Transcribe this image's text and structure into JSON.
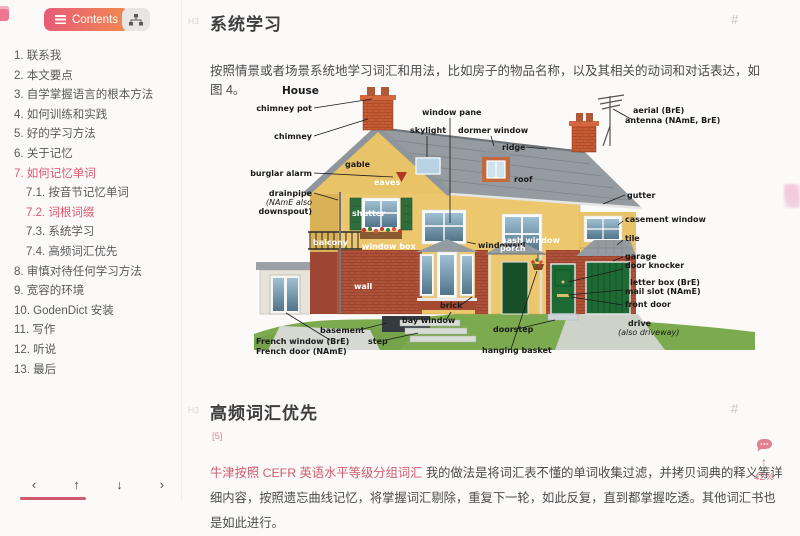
{
  "sidebar": {
    "contents_button": "Contents",
    "toc": [
      {
        "label": "1. 联系我"
      },
      {
        "label": "2. 本文要点"
      },
      {
        "label": "3. 自学掌握语言的根本方法"
      },
      {
        "label": "4. 如何训练和实践"
      },
      {
        "label": "5. 好的学习方法"
      },
      {
        "label": "6. 关于记忆"
      },
      {
        "label": "7. 如何记忆单词",
        "active": true
      },
      {
        "label": "7.1. 按音节记忆单词",
        "indent": 1
      },
      {
        "label": "7.2. 词根词缀",
        "indent": 1,
        "active": true
      },
      {
        "label": "7.3. 系统学习",
        "indent": 1
      },
      {
        "label": "7.4. 高频词汇优先",
        "indent": 1
      },
      {
        "label": "8. 审慎对待任何学习方法"
      },
      {
        "label": "9. 宽容的环境"
      },
      {
        "label": "10. GodenDict 安装"
      },
      {
        "label": "11. 写作"
      },
      {
        "label": "12. 听说"
      },
      {
        "label": "13. 最后"
      }
    ],
    "footer_arrows": [
      "‹",
      "↑",
      "↓",
      "›"
    ]
  },
  "content": {
    "section1": {
      "level_marker": "H3",
      "title": "系统学习",
      "anchor": "#",
      "paragraph": "按照情景或者场景系统地学习词汇和用法，比如房子的物品名称，以及其相关的动词和对话表达，如图 4。"
    },
    "section2": {
      "level_marker": "H3",
      "title": "高频词汇优先",
      "anchor": "#",
      "footnote": "[5]",
      "link_text": "牛津按照 CEFR 英语水平等级分组词汇",
      "paragraph_rest": " 我的做法是将词汇表不懂的单词收集过滤，并拷贝词典的释义等详细内容，按照遗忘曲线记忆，将掌握词汇剔除，重复下一轮，如此反复，直到都掌握吃透。其他词汇书也是如此进行。"
    }
  },
  "figure_labels": [
    {
      "t": "House",
      "x": 32,
      "y": 12,
      "a": "s",
      "c": "d",
      "sz": 10.5
    },
    {
      "t": "chimney pot",
      "x": 62,
      "y": 29,
      "a": "e",
      "c": "d",
      "ln": [
        64,
        26,
        122,
        17
      ]
    },
    {
      "t": "chimney",
      "x": 62,
      "y": 57,
      "a": "e",
      "c": "d",
      "ln": [
        64,
        54,
        118,
        37
      ]
    },
    {
      "t": "burglar alarm",
      "x": 62,
      "y": 94,
      "a": "e",
      "c": "d",
      "ln": [
        64,
        91,
        143,
        95
      ]
    },
    {
      "t": "drainpipe",
      "x": 62,
      "y": 114,
      "a": "e",
      "c": "d",
      "ln": [
        64,
        111,
        88,
        118
      ]
    },
    {
      "t": "(NAmE also",
      "x": 62,
      "y": 123,
      "a": "e",
      "c": "d",
      "it": 1
    },
    {
      "t": "downspout)",
      "x": 62,
      "y": 132,
      "a": "e",
      "c": "d"
    },
    {
      "t": "French window (BrE)",
      "x": 6,
      "y": 262,
      "a": "s",
      "c": "d",
      "ln": [
        80,
        258,
        36,
        231
      ]
    },
    {
      "t": "French door (NAmE)",
      "x": 6,
      "y": 272,
      "a": "s",
      "c": "d"
    },
    {
      "t": "basement",
      "x": 70,
      "y": 251,
      "a": "s",
      "c": "d",
      "ln": [
        109,
        248,
        137,
        241
      ]
    },
    {
      "t": "step",
      "x": 118,
      "y": 262,
      "a": "s",
      "c": "d",
      "ln": [
        136,
        258,
        168,
        251
      ]
    },
    {
      "t": "bay window",
      "x": 152,
      "y": 241,
      "a": "s",
      "c": "d",
      "ln": [
        196,
        238,
        201,
        230
      ]
    },
    {
      "t": "doorstep",
      "x": 243,
      "y": 250,
      "a": "s",
      "c": "d",
      "ln": [
        267,
        247,
        305,
        238
      ]
    },
    {
      "t": "hanging basket",
      "x": 232,
      "y": 271,
      "a": "s",
      "c": "d",
      "ln": [
        261,
        267,
        287,
        189
      ]
    },
    {
      "t": "brick",
      "x": 190,
      "y": 226,
      "a": "s",
      "c": "d",
      "ln": [
        211,
        223,
        222,
        215
      ]
    },
    {
      "t": "window pane",
      "x": 172,
      "y": 33,
      "a": "s",
      "c": "d",
      "ln": [
        200,
        36,
        200,
        141
      ]
    },
    {
      "t": "skylight",
      "x": 160,
      "y": 51,
      "a": "s",
      "c": "d",
      "ln": [
        177,
        54,
        177,
        75
      ]
    },
    {
      "t": "dormer window",
      "x": 208,
      "y": 51,
      "a": "s",
      "c": "d",
      "ln": [
        241,
        54,
        244,
        64
      ]
    },
    {
      "t": "ridge",
      "x": 252,
      "y": 68,
      "a": "s",
      "c": "d",
      "ln": [
        276,
        65,
        297,
        67
      ]
    },
    {
      "t": "roof",
      "x": 264,
      "y": 100,
      "a": "s",
      "c": "d"
    },
    {
      "t": "gable",
      "x": 95,
      "y": 85,
      "a": "s",
      "c": "d"
    },
    {
      "t": "eaves",
      "x": 124,
      "y": 103,
      "a": "s",
      "c": "l"
    },
    {
      "t": "shutter",
      "x": 102,
      "y": 134,
      "a": "s",
      "c": "l"
    },
    {
      "t": "window box",
      "x": 112,
      "y": 167,
      "a": "s",
      "c": "l"
    },
    {
      "t": "windowsill",
      "x": 228,
      "y": 166,
      "a": "s",
      "c": "d",
      "ln": [
        226,
        162,
        217,
        160
      ]
    },
    {
      "t": "sash window",
      "x": 252,
      "y": 161,
      "a": "s",
      "c": "l"
    },
    {
      "t": "porch",
      "x": 250,
      "y": 169,
      "a": "s",
      "c": "l"
    },
    {
      "t": "balcony",
      "x": 63,
      "y": 163,
      "a": "s",
      "c": "l"
    },
    {
      "t": "wall",
      "x": 104,
      "y": 207,
      "a": "s",
      "c": "l"
    },
    {
      "t": "aerial (BrE)",
      "x": 383,
      "y": 31,
      "a": "s",
      "c": "d",
      "ln": [
        381,
        37,
        363,
        27
      ]
    },
    {
      "t": "antenna (NAmE, BrE)",
      "x": 375,
      "y": 41,
      "a": "s",
      "c": "d"
    },
    {
      "t": "gutter",
      "x": 377,
      "y": 116,
      "a": "s",
      "c": "d",
      "ln": [
        375,
        113,
        353,
        122
      ]
    },
    {
      "t": "casement window",
      "x": 375,
      "y": 140,
      "a": "s",
      "c": "d",
      "ln": [
        373,
        139,
        368,
        143
      ]
    },
    {
      "t": "tile",
      "x": 375,
      "y": 159,
      "a": "s",
      "c": "d",
      "ln": [
        373,
        158,
        367,
        163
      ]
    },
    {
      "t": "garage",
      "x": 375,
      "y": 177,
      "a": "s",
      "c": "d",
      "ln": [
        373,
        175,
        363,
        179
      ]
    },
    {
      "t": "door knocker",
      "x": 375,
      "y": 186,
      "a": "s",
      "c": "d",
      "ln": [
        373,
        187,
        318,
        200
      ]
    },
    {
      "t": "letter box (BrE)",
      "x": 380,
      "y": 203,
      "a": "s",
      "c": "d",
      "ln": [
        373,
        208,
        318,
        213
      ]
    },
    {
      "t": "mail slot (NAmE)",
      "x": 375,
      "y": 212,
      "a": "s",
      "c": "d"
    },
    {
      "t": "front door",
      "x": 375,
      "y": 225,
      "a": "s",
      "c": "d",
      "ln": [
        373,
        223,
        321,
        215
      ]
    },
    {
      "t": "drive",
      "x": 378,
      "y": 244,
      "a": "s",
      "c": "d"
    },
    {
      "t": "(also driveway)",
      "x": 368,
      "y": 253,
      "a": "s",
      "c": "d",
      "it": 1
    }
  ],
  "widgets": {
    "progress": "42%",
    "up_arrow": "↑"
  },
  "colors": {
    "accent_pink": "#e0566e",
    "button_gradient": [
      "#e85c77",
      "#f0894f"
    ],
    "link": "#d15b6f",
    "progress": "#cf5a72"
  }
}
